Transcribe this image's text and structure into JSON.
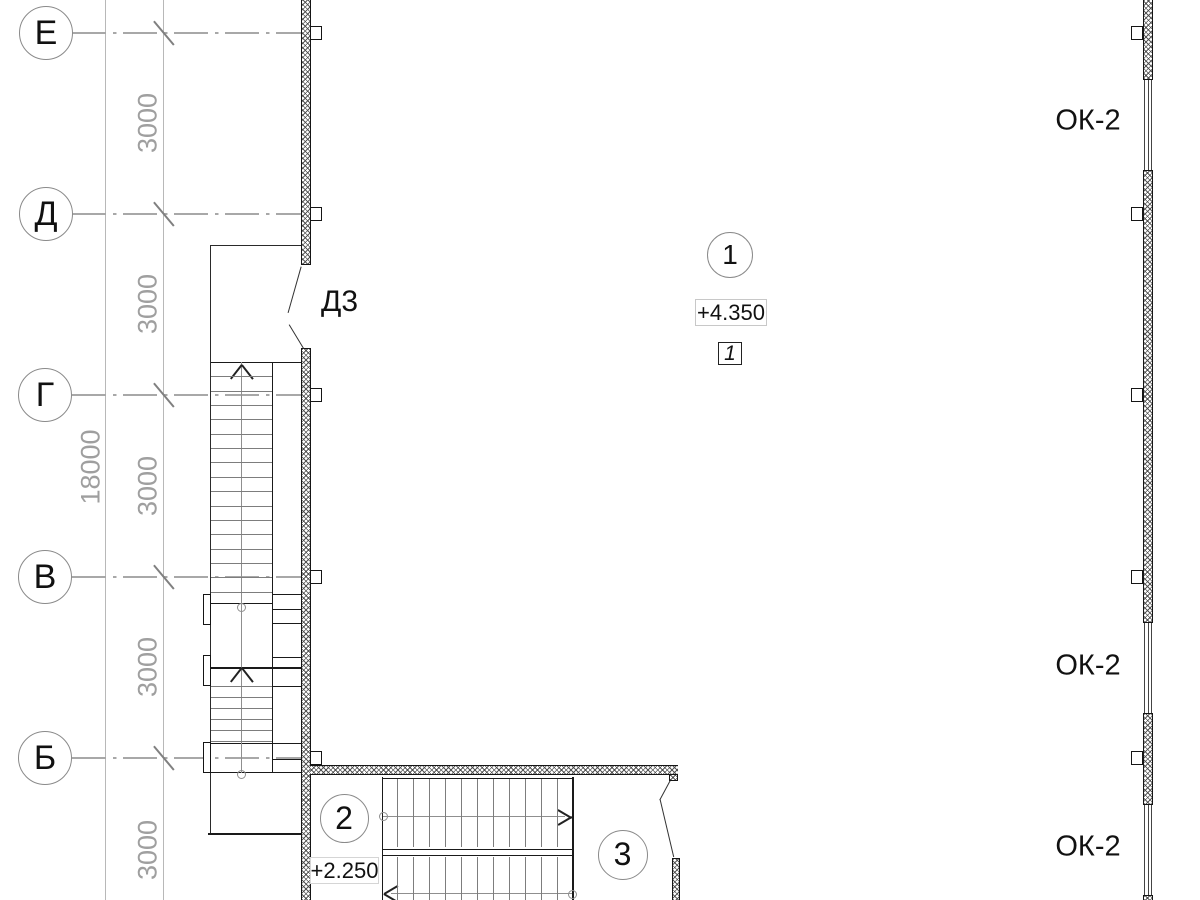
{
  "colors": {
    "ink": "#1a1a1a",
    "annotation_gray": "#9f9f9f",
    "wall_hatch": "#464646"
  },
  "grid": {
    "axes": [
      {
        "label": "Е"
      },
      {
        "label": "Д"
      },
      {
        "label": "Г"
      },
      {
        "label": "В"
      },
      {
        "label": "Б"
      }
    ]
  },
  "dimensions": {
    "overall": "18000",
    "bays": [
      "3000",
      "3000",
      "3000",
      "3000",
      "3000"
    ]
  },
  "door": {
    "label": "Д3"
  },
  "windows": {
    "labels": [
      "ОК-2",
      "ОК-2",
      "ОК-2"
    ]
  },
  "markers": {
    "node_1": "1",
    "node_2": "2",
    "node_3": "3",
    "floor_type": "1"
  },
  "elevations": {
    "upper": "+4.350",
    "lower": "+2.250"
  }
}
